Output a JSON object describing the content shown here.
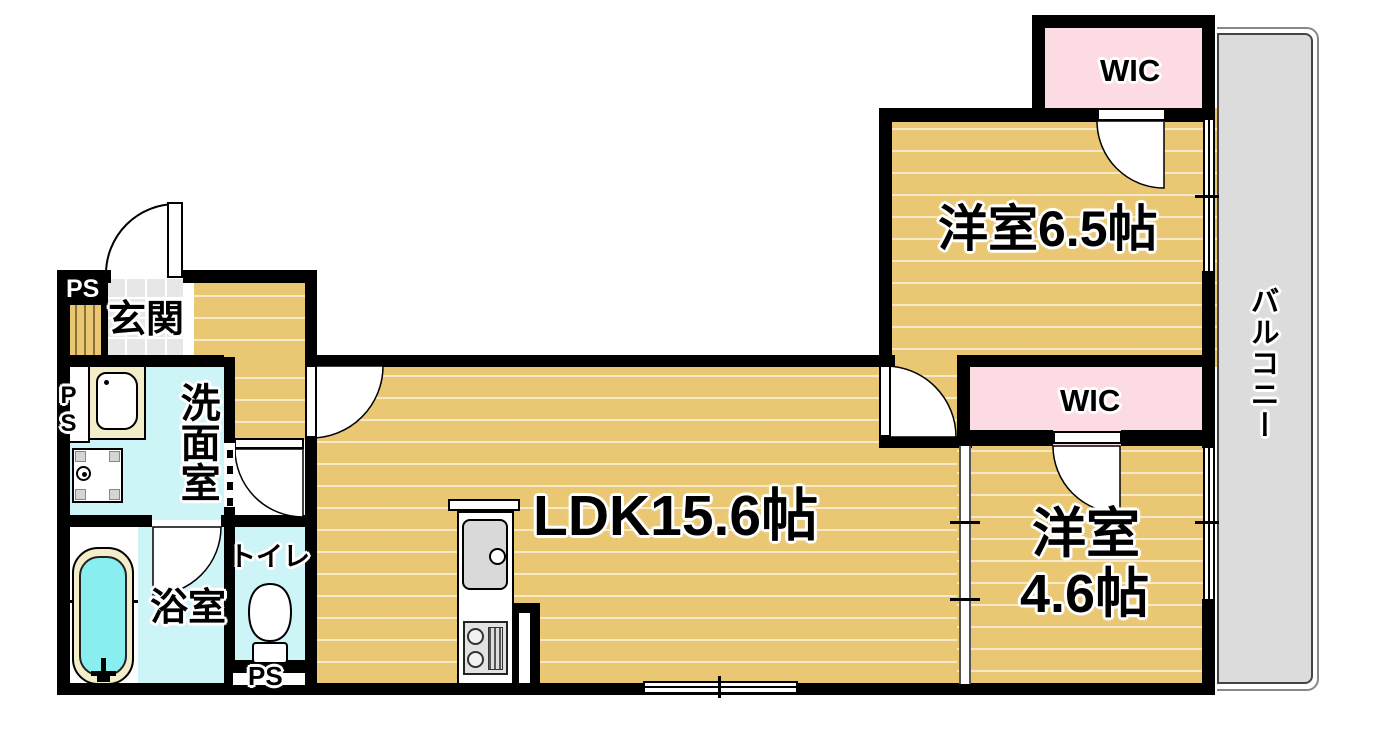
{
  "labels": {
    "entrance": "玄関",
    "washroom": "洗面室",
    "bathroom": "浴室",
    "toilet": "トイレ",
    "ldk": "LDK15.6帖",
    "bedroom_65": "洋室6.5帖",
    "bedroom_46_line1": "洋室",
    "bedroom_46_line2": "4.6帖",
    "wic_upper": "WIC",
    "wic_lower": "WIC",
    "balcony": "バルコニー",
    "ps_entrance": "PS",
    "ps_washroom": "PS",
    "ps_toilet": "PS"
  },
  "colors": {
    "wall": "#000000",
    "wood_floor": "#eac873",
    "water_room_cyan": "#cdf4f7",
    "closet_pink": "#fcdce2",
    "balcony_gray": "#dcdcdc",
    "tub_water": "#88eef0",
    "fixture_cream": "#f3eec9",
    "entrance_tile": "#e7e7e7"
  }
}
